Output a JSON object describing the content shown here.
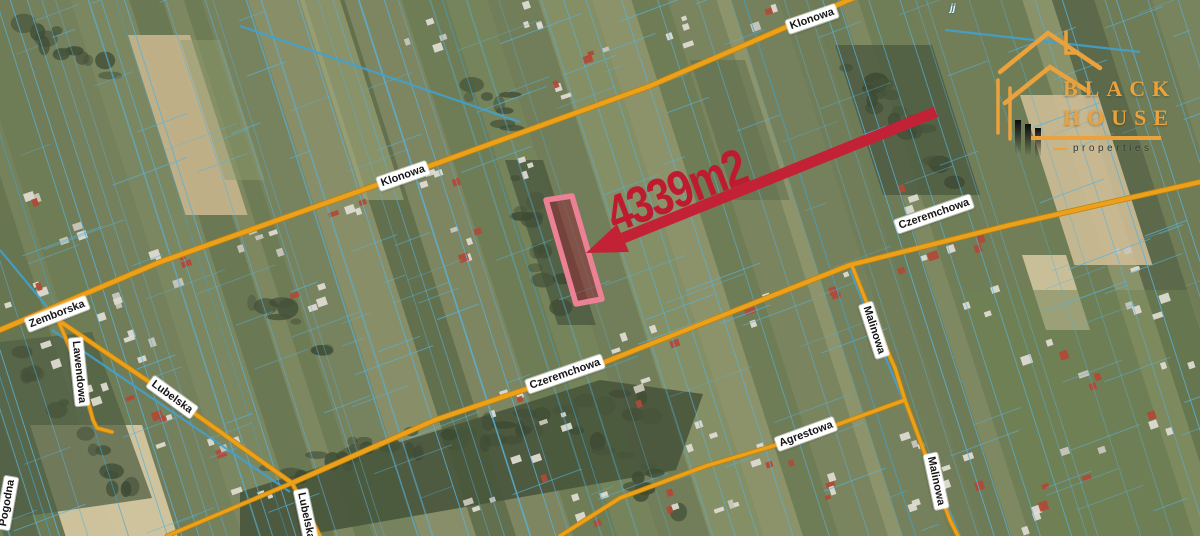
{
  "map": {
    "street_labels": [
      {
        "text": "Klonowa",
        "x": 812,
        "y": 19,
        "rot": -19
      },
      {
        "text": "Klonowa",
        "x": 403,
        "y": 176,
        "rot": -19
      },
      {
        "text": "Czeremchowa",
        "x": 934,
        "y": 214,
        "rot": -19
      },
      {
        "text": "Czeremchowa",
        "x": 565,
        "y": 374,
        "rot": -19
      },
      {
        "text": "Zemborska",
        "x": 57,
        "y": 314,
        "rot": -21
      },
      {
        "text": "Lawendowa",
        "x": 79,
        "y": 372,
        "rot": 84
      },
      {
        "text": "Lubelska",
        "x": 172,
        "y": 397,
        "rot": 36
      },
      {
        "text": "Lubelska",
        "x": 306,
        "y": 516,
        "rot": 78
      },
      {
        "text": "Malinowa",
        "x": 874,
        "y": 330,
        "rot": 72
      },
      {
        "text": "Malinowa",
        "x": 936,
        "y": 481,
        "rot": 78
      },
      {
        "text": "Agrestowa",
        "x": 806,
        "y": 434,
        "rot": -20
      },
      {
        "text": "Pogodna",
        "x": 7,
        "y": 503,
        "rot": -80
      }
    ],
    "corner_text": "jj",
    "colors": {
      "cadastral": "#58b2dd",
      "cadastral_bold": "#3fa3d4",
      "road": "#eda01a",
      "road_casing": "#bd830e"
    }
  },
  "annotation": {
    "area_label": "4339m2",
    "text_color": "#be1b31",
    "arrow_color": "#c22136",
    "parcel_outline": "#ec8196",
    "parcel_fill": "rgba(150,35,52,0.48)",
    "parcel_points": "546,200 572,196 602,299 576,304",
    "arrow_from": [
      936,
      112
    ],
    "arrow_shaft_end": [
      623,
      238
    ],
    "arrow_head": "586,253 617,224 629,252",
    "label_pos": {
      "x": 676,
      "y": 190,
      "rot": -21
    }
  },
  "logo": {
    "line1": "BLACK",
    "line2": "HOUSE",
    "line3": "properties",
    "accent": "#eba23c"
  }
}
